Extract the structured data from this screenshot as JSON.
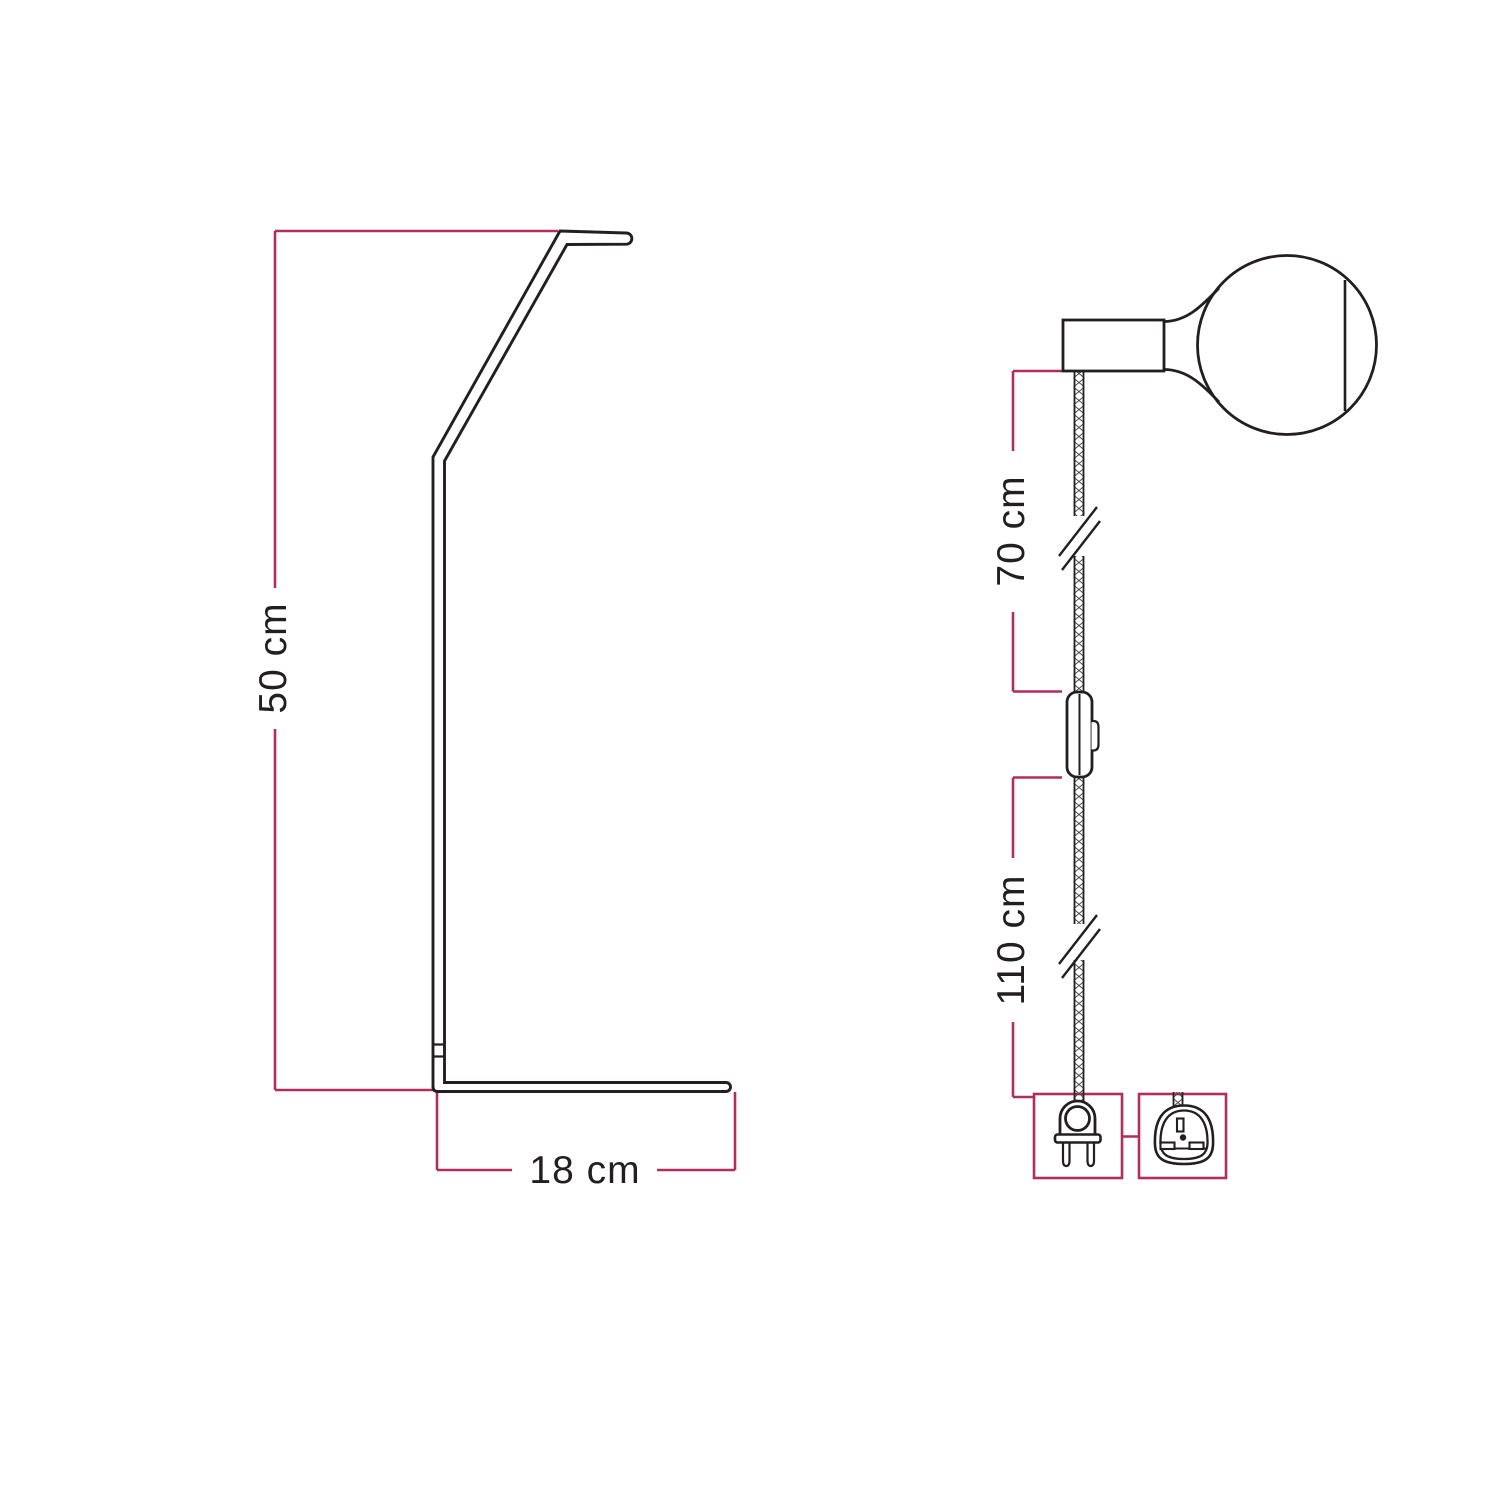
{
  "canvas": {
    "width": 1500,
    "height": 1500,
    "background": "#ffffff"
  },
  "colors": {
    "outline": "#231f20",
    "dimension_line": "#b22d5e",
    "cable_hatch": "#4a4a4a"
  },
  "left_diagram": {
    "name": "lamp-stand-side-view",
    "height_label": "50 cm",
    "base_label": "18 cm",
    "icons": [
      "floor-stand-outline-icon"
    ]
  },
  "right_diagram": {
    "name": "pendant-cable-assembly-view",
    "upper_cable_label": "70 cm",
    "lower_cable_label": "110 cm",
    "icons": [
      "light-bulb-icon",
      "lamp-socket-icon",
      "textile-cable-icon",
      "cable-break-icon",
      "inline-switch-icon",
      "euro-plug-icon",
      "uk-plug-icon"
    ]
  },
  "measurements": [
    {
      "target": "stand-height",
      "value": "50 cm"
    },
    {
      "target": "stand-base-depth",
      "value": "18 cm"
    },
    {
      "target": "cable-socket-to-switch",
      "value": "70 cm"
    },
    {
      "target": "cable-switch-to-plug",
      "value": "110 cm"
    }
  ]
}
